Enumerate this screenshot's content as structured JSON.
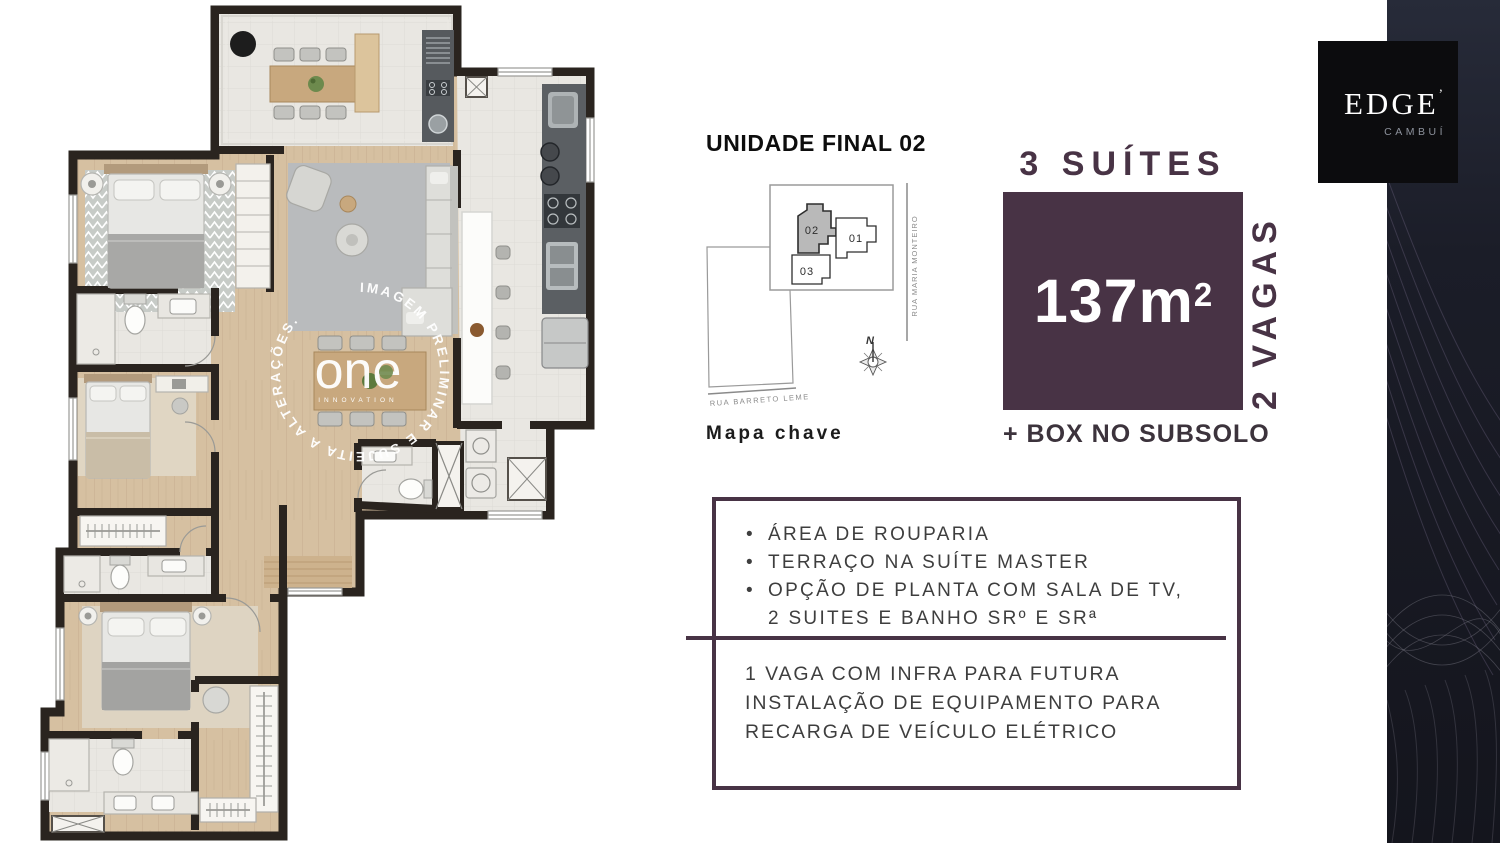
{
  "plan": {
    "watermark": {
      "circle_text": "IMAGEM PRELIMINAR E SUJEITA A ALTERAÇÕES.",
      "brand": "one",
      "brand_sub": "INNOVATION"
    }
  },
  "unit_block": {
    "title": "UNIDADE FINAL 02",
    "map_caption": "Mapa chave",
    "key_map": {
      "unit_01": "01",
      "unit_02": "02",
      "unit_03": "03",
      "street_right": "RUA MARIA MONTEIRO",
      "street_bottom": "RUA BARRETO LEME",
      "compass_north": "N"
    }
  },
  "spec_block": {
    "suites": "3 SUÍTES",
    "area": "137m",
    "area_exp": "2",
    "parking": "2 VAGAS",
    "storage": "+ BOX NO SUBSOLO"
  },
  "features_box": {
    "bullet_char": "•",
    "bullets": [
      "ÁREA DE ROUPARIA",
      "TERRAÇO NA SUÍTE MASTER",
      [
        "OPÇÃO DE PLANTA COM SALA DE TV,",
        "2 SUITES E BANHO SRº E SRª"
      ]
    ],
    "note_lines": [
      "1 VAGA COM INFRA PARA FUTURA",
      "INSTALAÇÃO DE EQUIPAMENTO PARA",
      "RECARGA DE VEÍCULO ELÉTRICO"
    ]
  },
  "brand_block": {
    "logo": "EDGE",
    "logo_tick": "’",
    "location": "CAMBUÍ"
  },
  "colors": {
    "accent": "#483345",
    "band": "#171822",
    "wall": "#2a241f"
  }
}
